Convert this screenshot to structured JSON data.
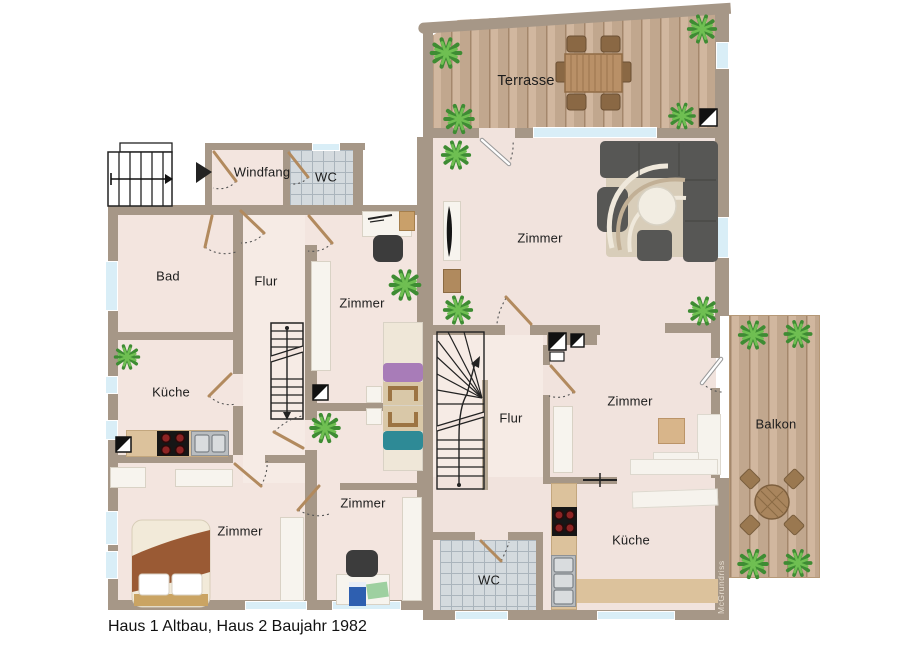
{
  "meta": {
    "caption": "Haus 1 Altbau, Haus 2 Baujahr 1982",
    "watermark": "McGrundriss",
    "type": "floor-plan"
  },
  "houses": {
    "haus1": {
      "name": "Haus 1 Altbau",
      "rooms": {
        "windfang": "Windfang",
        "wc": "WC",
        "bad": "Bad",
        "flur": "Flur",
        "kueche": "Küche",
        "zimmer_oben": "Zimmer",
        "zimmer_links": "Zimmer",
        "zimmer_mitte": "Zimmer"
      }
    },
    "haus2": {
      "name": "Haus 2 Baujahr 1982",
      "rooms": {
        "terrasse": "Terrasse",
        "zimmer_wohnen": "Zimmer",
        "flur": "Flur",
        "zimmer": "Zimmer",
        "kueche": "Küche",
        "wc": "WC",
        "balkon": "Balkon"
      }
    }
  },
  "colors": {
    "wall": "#a69787",
    "floor": "#f3e5df",
    "floor_flur": "#f6ebe5",
    "deck_wood": "#cdb197",
    "tile": "#d4dade",
    "window_glass": "#d9eef7",
    "plant_green": "#3e8c33",
    "sofa_gray": "#575755",
    "bed_purple": "#a87cb8",
    "bed_teal": "#2e8a96",
    "blanket_brown": "#9a5a34",
    "door_leaf": "#b28a5e"
  },
  "icons": {
    "entrance_arrow": "right-filled-triangle",
    "stair_direction": "line-with-arrowhead",
    "chimney_marker": "half-black-square",
    "door_swing": "dotted-quarter-arc"
  }
}
